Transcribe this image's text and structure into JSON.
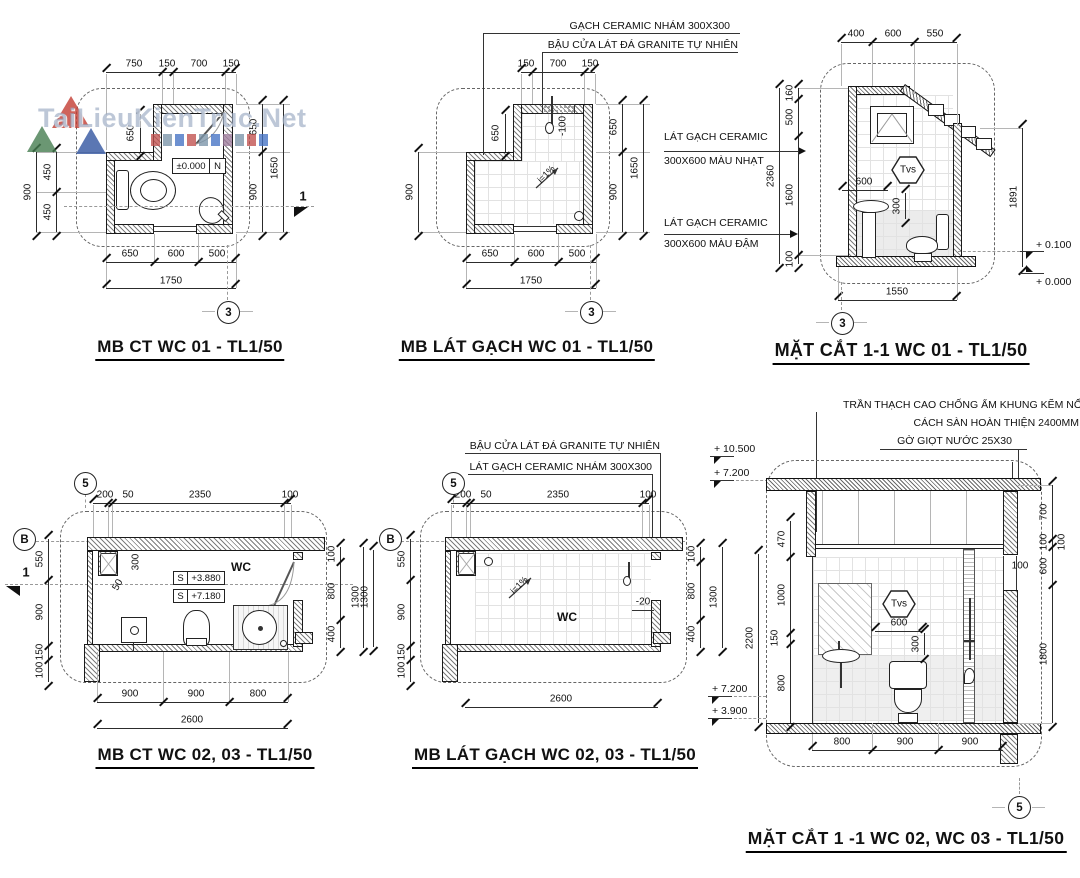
{
  "watermark": {
    "text": "TaiLieuKienTruc.Net",
    "square_colors": [
      "#c0504d",
      "#7a93a8",
      "#4472c4",
      "#c0504d",
      "#7a93a8",
      "#4472c4",
      "#9e7b9b",
      "#7a93a8",
      "#c0504d",
      "#4472c4"
    ]
  },
  "ann": {
    "gach_nham_300": "GẠCH CERAMIC NHÁM 300X300",
    "bau_cua": "BẬU CỬA LÁT ĐÁ GRANITE TỰ NHIÊN",
    "lat_gach_1": "LÁT GẠCH CERAMIC",
    "mau_nhat": "300X600 MÀU NHẠT",
    "lat_gach_2": "LÁT GẠCH CERAMIC",
    "mau_dam": "300X600 MÀU ĐẬM",
    "bau_cua2": "BẬU CỬA LÁT ĐÁ GRANITE TỰ NHIÊN",
    "lat_gach_nham": "LÁT GẠCH CERAMIC NHÁM 300X300",
    "tran": "TRẦN THẠCH CAO CHỐNG ẨM KHUNG KẼM NỔI",
    "cach_san": "CÁCH SÀN HOÀN THIỆN 2400MM",
    "go_giot": "GỜ GIỌT NƯỚC 25X30"
  },
  "p1": {
    "title": "MB CT WC 01 - TL1/50",
    "bubble": "3",
    "sec": "1",
    "top": [
      "750",
      "150",
      "700",
      "150"
    ],
    "left_total": "900",
    "left": [
      "450",
      "450"
    ],
    "inner650": "650",
    "right": [
      "650",
      "900"
    ],
    "right_total": "1650",
    "bottom": [
      "650",
      "600",
      "500"
    ],
    "bottom_total": "1750",
    "level": "±0.000",
    "level_dir": "N"
  },
  "p2": {
    "title": "MB LÁT GẠCH WC 01 - TL1/50",
    "bubble": "3",
    "top": [
      "150",
      "700",
      "150"
    ],
    "left_total": "900",
    "inner650": "650",
    "right": [
      "650",
      "900"
    ],
    "right_total": "1650",
    "bottom": [
      "650",
      "600",
      "500"
    ],
    "bottom_total": "1750",
    "drop": "-100",
    "slope": "i=1%"
  },
  "p3": {
    "title": "MẶT CẮT 1-1 WC 01 - TL1/50",
    "bubble": "3",
    "top": [
      "400",
      "600",
      "550"
    ],
    "left": [
      "160",
      "500",
      "1600",
      "100"
    ],
    "left_total": "2360",
    "right_total": "1891",
    "lv1": "+ 0.100",
    "lv2": "+ 0.000",
    "tvs": "Tvs",
    "d600": "600",
    "d300": "300",
    "bottom_total": "1550"
  },
  "p4": {
    "title": "MB CT WC 02, 03 - TL1/50",
    "bub5": "5",
    "bubB": "B",
    "sec": "1",
    "top": [
      "200",
      "50",
      "2350",
      "100"
    ],
    "left": [
      "550",
      "900",
      "150",
      "100"
    ],
    "right": [
      "100",
      "800",
      "400"
    ],
    "right_total": "1300",
    "bottom": [
      "900",
      "900",
      "800"
    ],
    "bottom_total": "2600",
    "wc": "WC",
    "s1": "S",
    "v1": "+3.880",
    "s2": "S",
    "v2": "+7.180",
    "d300": "300",
    "d50": "50"
  },
  "p5": {
    "title": "MB LÁT GẠCH WC 02, 03 - TL1/50",
    "bub5": "5",
    "bubB": "B",
    "top": [
      "200",
      "50",
      "2350",
      "100"
    ],
    "left": [
      "550",
      "900",
      "150",
      "100"
    ],
    "left_total": "1300",
    "right": [
      "100",
      "800",
      "400"
    ],
    "right_total": "1300",
    "bottom_total": "2600",
    "wc": "WC",
    "slope": "i=1%",
    "drop": "-20"
  },
  "p6": {
    "title": "MẶT CẮT  1 -1 WC 02, WC 03 - TL1/50",
    "bubble": "5",
    "lv_top": [
      "+ 10.500",
      "+ 7.200"
    ],
    "lv_bot": [
      "+ 7.200",
      "+ 3.900"
    ],
    "left": [
      "470",
      "1000",
      "150",
      "800"
    ],
    "left_total": "2200",
    "right": [
      "700",
      "100",
      "600"
    ],
    "right2": "100",
    "right_total": "1800",
    "inner100": "100",
    "tvs": "Tvs",
    "d600": "600",
    "d300": "300",
    "bottom": [
      "800",
      "900",
      "900"
    ]
  }
}
